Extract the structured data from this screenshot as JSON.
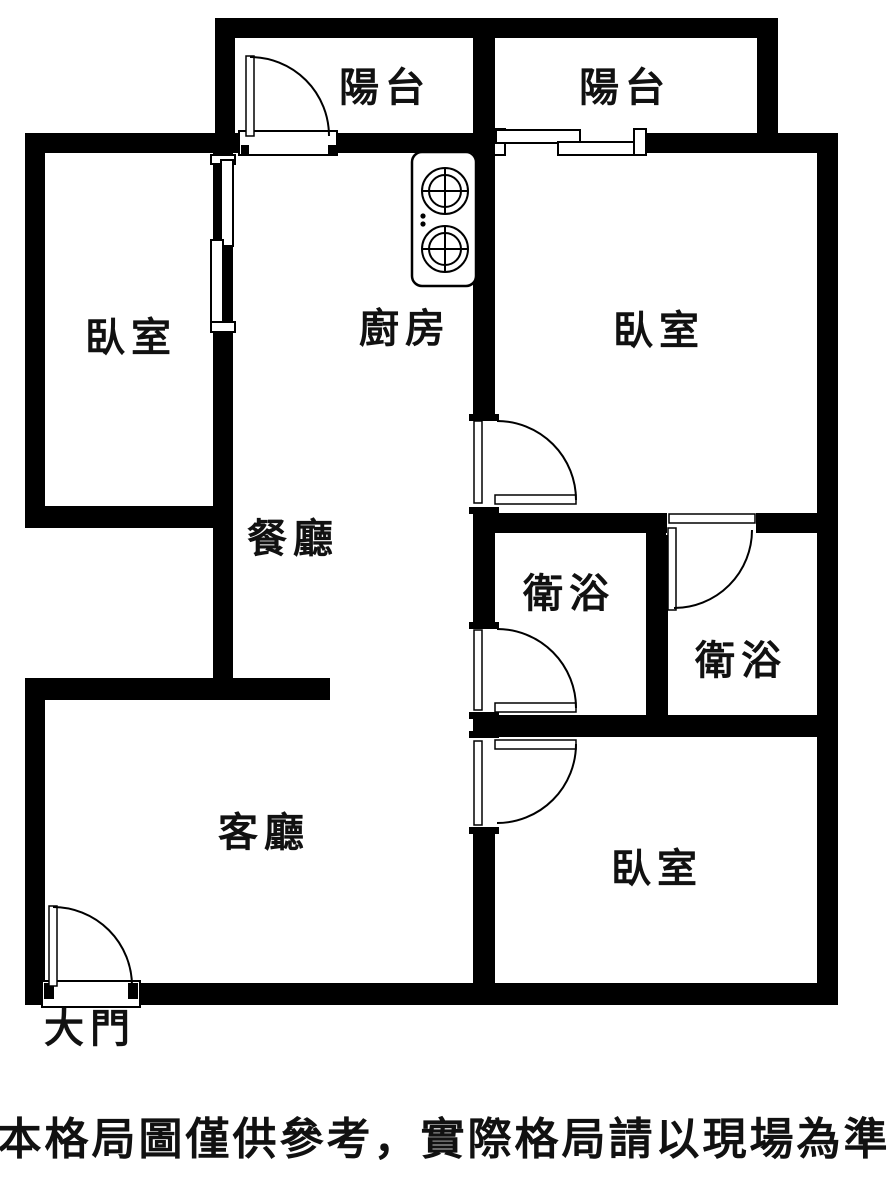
{
  "floor_plan": {
    "rooms": [
      {
        "id": "balcony-1",
        "label": "陽台"
      },
      {
        "id": "balcony-2",
        "label": "陽台"
      },
      {
        "id": "bedroom-left",
        "label": "臥室"
      },
      {
        "id": "kitchen",
        "label": "廚房"
      },
      {
        "id": "bedroom-top-right",
        "label": "臥室"
      },
      {
        "id": "dining-room",
        "label": "餐廳"
      },
      {
        "id": "bathroom-left",
        "label": "衛浴"
      },
      {
        "id": "bathroom-right",
        "label": "衛浴"
      },
      {
        "id": "living-room",
        "label": "客廳"
      },
      {
        "id": "bedroom-bottom-right",
        "label": "臥室"
      },
      {
        "id": "main-door",
        "label": "大門"
      }
    ],
    "disclaimer": "本格局圖僅供參考，實際格局請以現場為準",
    "symbols": {
      "stove": "two-burner-stove-icon",
      "swing_door": "quarter-circle-door-arc",
      "sliding_door": "offset-double-panel"
    },
    "colors": {
      "wall": "#000000",
      "background": "#ffffff",
      "text": "#111111"
    }
  }
}
